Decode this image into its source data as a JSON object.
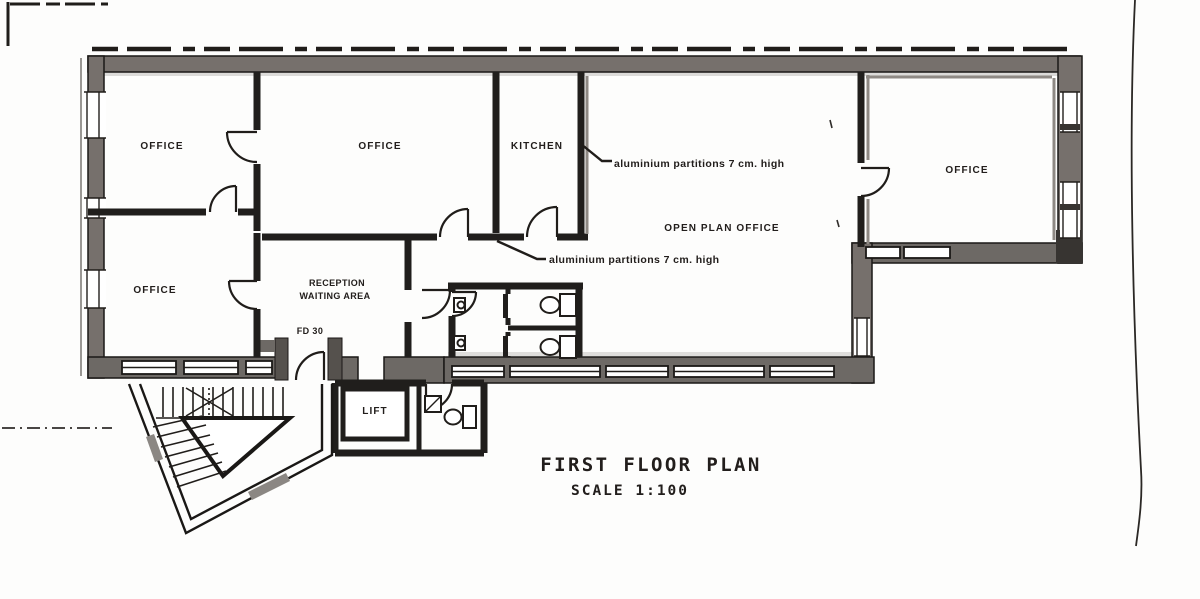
{
  "drawing": {
    "title": "FIRST FLOOR PLAN",
    "scale_label": "SCALE 1:100"
  },
  "rooms": {
    "office_top_left": "OFFICE",
    "office_middle": "OFFICE",
    "kitchen": "KITCHEN",
    "office_bottom_left": "OFFICE",
    "reception_line1": "RECEPTION",
    "reception_line2": "WAITING AREA",
    "open_plan_office": "OPEN PLAN OFFICE",
    "office_right": "OFFICE",
    "lift": "LIFT",
    "fire_door": "FD 30"
  },
  "annotations": {
    "partition_note_upper": "aluminium partitions 7 cm. high",
    "partition_note_lower": "aluminium partitions 7 cm. high"
  },
  "colors": {
    "ink": "#24211e",
    "wall_gray": "#76716d",
    "wall_gray_dark": "#6e6a66",
    "paper": "#fdfdfc"
  }
}
